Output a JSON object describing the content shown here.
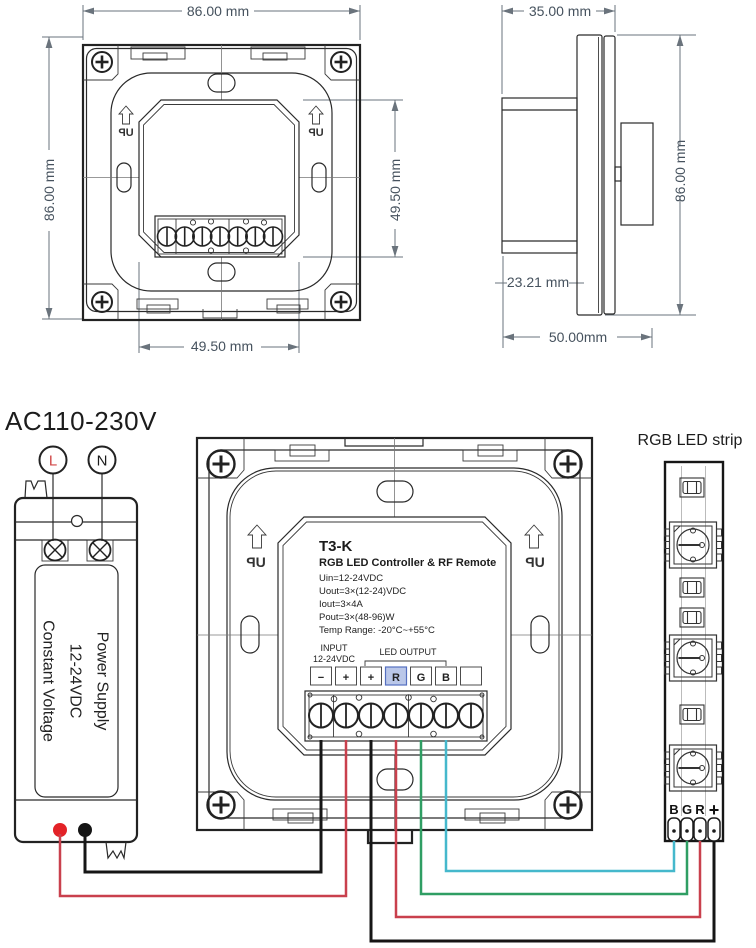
{
  "front_view": {
    "dim_width": "86.00 mm",
    "dim_height": "86.00 mm",
    "dim_inner_height": "49.50 mm",
    "dim_inner_width": "49.50 mm",
    "up_label": "UP"
  },
  "side_view": {
    "dim_width": "35.00 mm",
    "dim_height": "86.00 mm",
    "dim_depth": "23.21 mm",
    "dim_total_width": "50.00mm"
  },
  "wiring": {
    "ac_input_label": "AC110-230V",
    "live_label": "L",
    "neutral_label": "N",
    "power_supply_lines": [
      "Power Supply",
      "12-24VDC",
      "Constant Voltage"
    ],
    "controller": {
      "model": "T3-K",
      "title": "RGB LED Controller & RF Remote",
      "specs": [
        "Uin=12-24VDC",
        "Uout=3×(12-24)VDC",
        "Iout=3×4A",
        "Pout=3×(48-96)W",
        "Temp Range: -20°C~+55°C"
      ],
      "input_label": "INPUT",
      "input_voltage": "12-24VDC",
      "output_label": "LED OUTPUT",
      "terminal_labels": [
        "−",
        "+",
        "+",
        "R",
        "G",
        "B",
        ""
      ],
      "up_label": "UP"
    },
    "led_strip": {
      "label": "RGB LED strip",
      "pad_labels": [
        "B",
        "G",
        "R",
        "+"
      ]
    },
    "colors": {
      "wire_black": "#161616",
      "wire_red": "#c9404d",
      "wire_green": "#2f9e63",
      "wire_blue": "#45b8cc",
      "dot_red": "#e32227",
      "dot_black": "#151515",
      "live_red": "#d04545",
      "r_highlight_fill": "#bac7e9",
      "r_highlight_border": "#5570c0",
      "r_highlight_text": "#3a57b8"
    }
  }
}
